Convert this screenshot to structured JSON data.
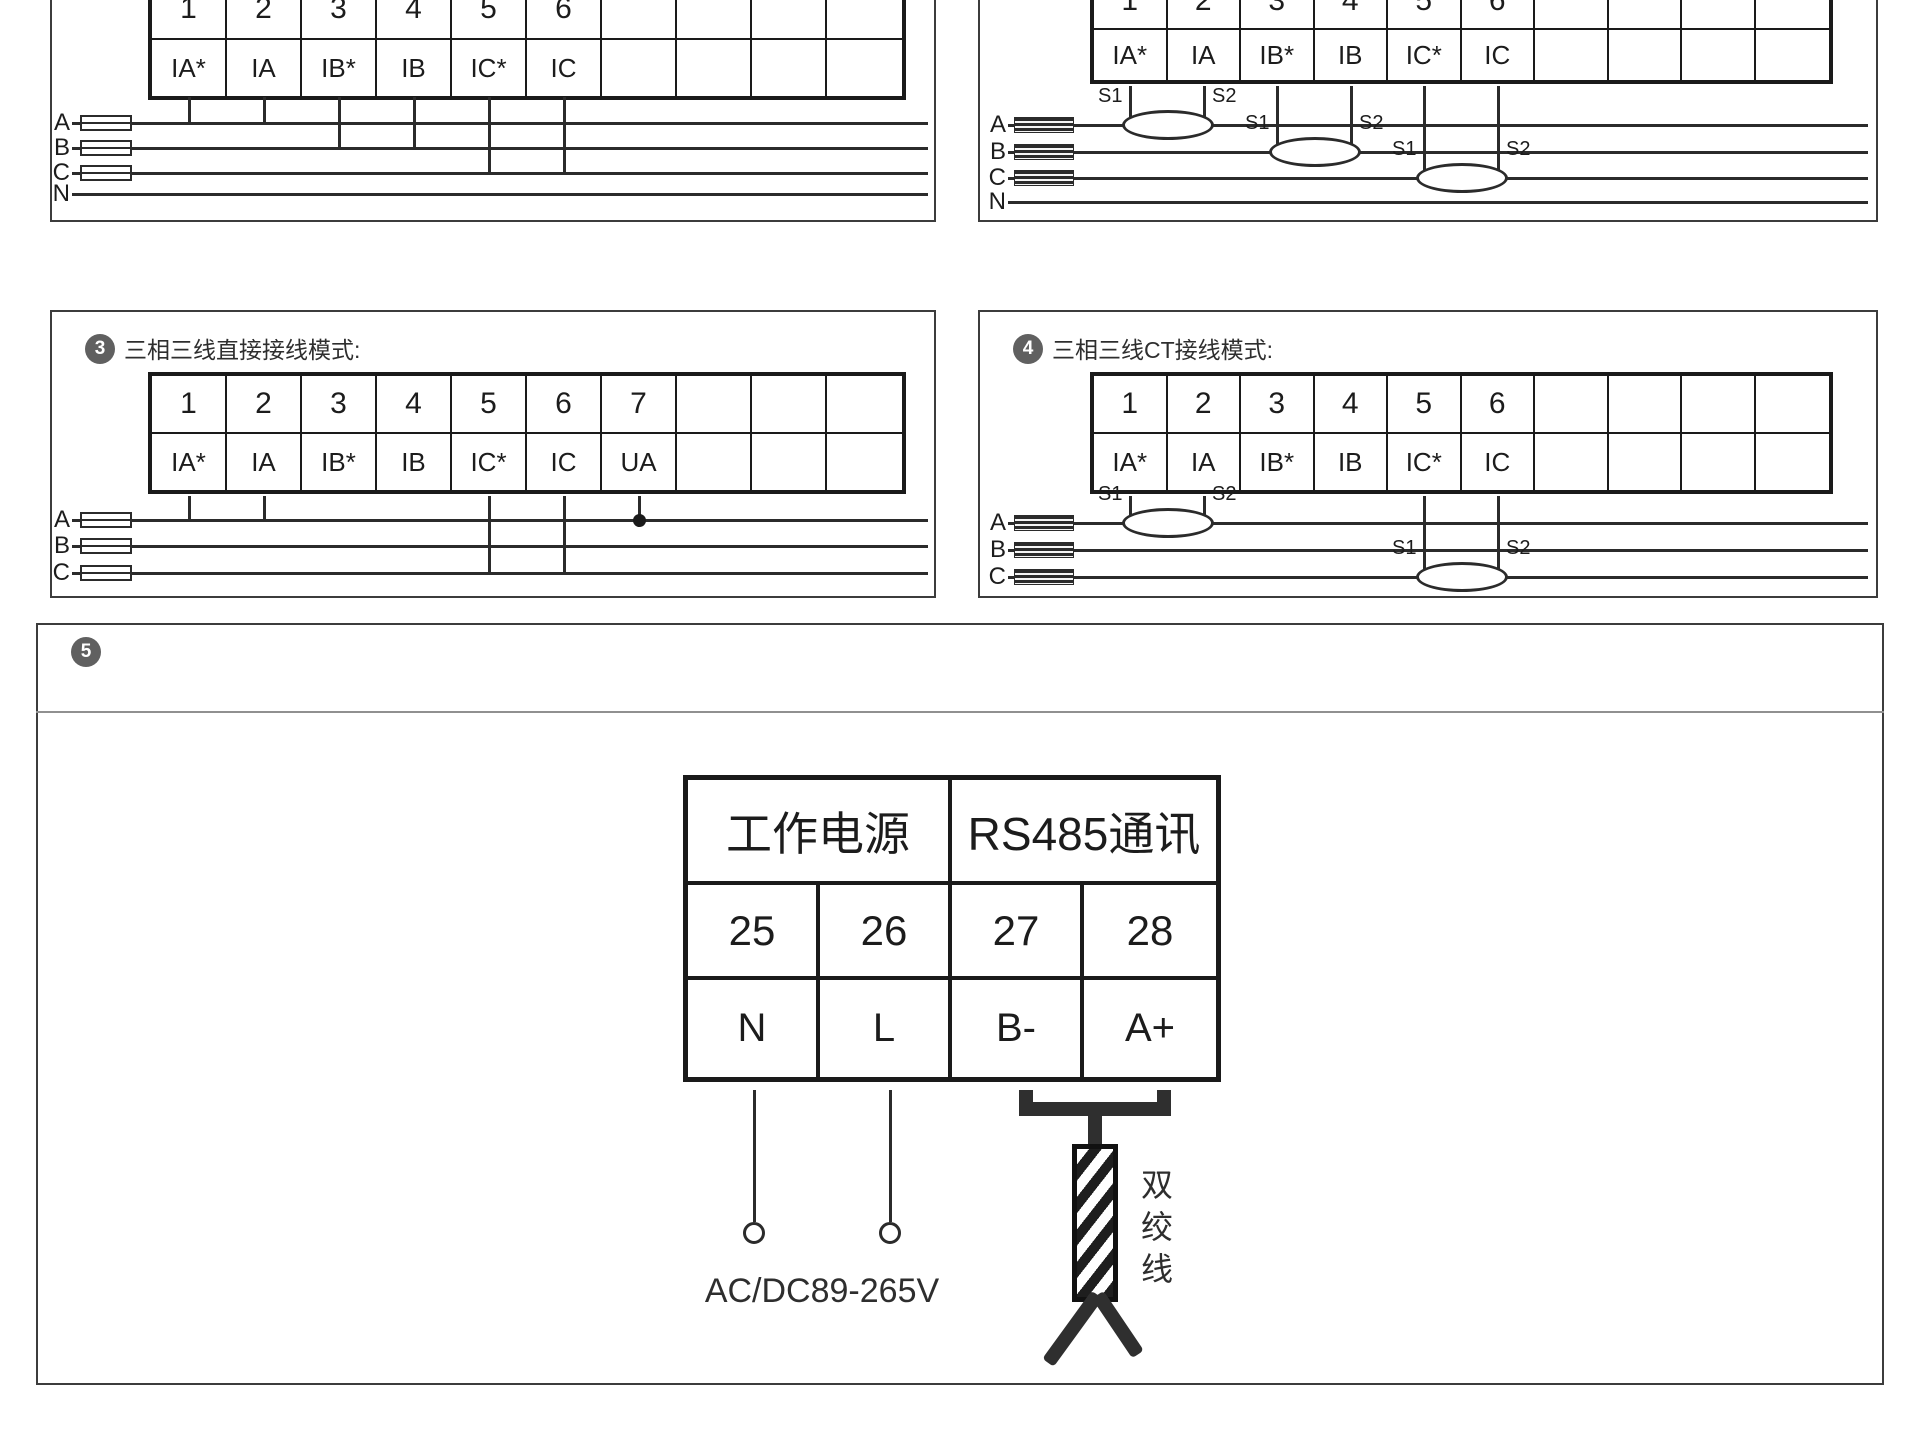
{
  "panel1": {
    "terminal_numbers": [
      "1",
      "2",
      "3",
      "4",
      "5",
      "6"
    ],
    "terminal_labels": [
      "IA*",
      "IA",
      "IB*",
      "IB",
      "IC*",
      "IC"
    ],
    "phases": {
      "a": "A",
      "b": "B",
      "c": "C",
      "n": "N"
    }
  },
  "panel2": {
    "terminal_numbers": [
      "1",
      "2",
      "3",
      "4",
      "5",
      "6"
    ],
    "terminal_labels": [
      "IA*",
      "IA",
      "IB*",
      "IB",
      "IC*",
      "IC"
    ],
    "phases": {
      "a": "A",
      "b": "B",
      "c": "C",
      "n": "N"
    },
    "ct": {
      "s1": "S1",
      "s2": "S2"
    }
  },
  "panel3": {
    "badge": "3",
    "title": "三相三线直接接线模式:",
    "terminal_numbers": [
      "1",
      "2",
      "3",
      "4",
      "5",
      "6",
      "7"
    ],
    "terminal_labels": [
      "IA*",
      "IA",
      "IB*",
      "IB",
      "IC*",
      "IC",
      "UA"
    ],
    "phases": {
      "a": "A",
      "b": "B",
      "c": "C"
    }
  },
  "panel4": {
    "badge": "4",
    "title": "三相三线CT接线模式:",
    "terminal_numbers": [
      "1",
      "2",
      "3",
      "4",
      "5",
      "6"
    ],
    "terminal_labels": [
      "IA*",
      "IA",
      "IB*",
      "IB",
      "IC*",
      "IC"
    ],
    "phases": {
      "a": "A",
      "b": "B",
      "c": "C"
    },
    "ct": {
      "s1": "S1",
      "s2": "S2"
    }
  },
  "panel5": {
    "badge": "5",
    "headers": [
      "工作电源",
      "RS485通讯"
    ],
    "terminal_numbers": [
      "25",
      "26",
      "27",
      "28"
    ],
    "terminal_labels": [
      "N",
      "L",
      "B-",
      "A+"
    ],
    "power_rating": "AC/DC89-265V",
    "twisted_pair_label": "双绞线"
  }
}
